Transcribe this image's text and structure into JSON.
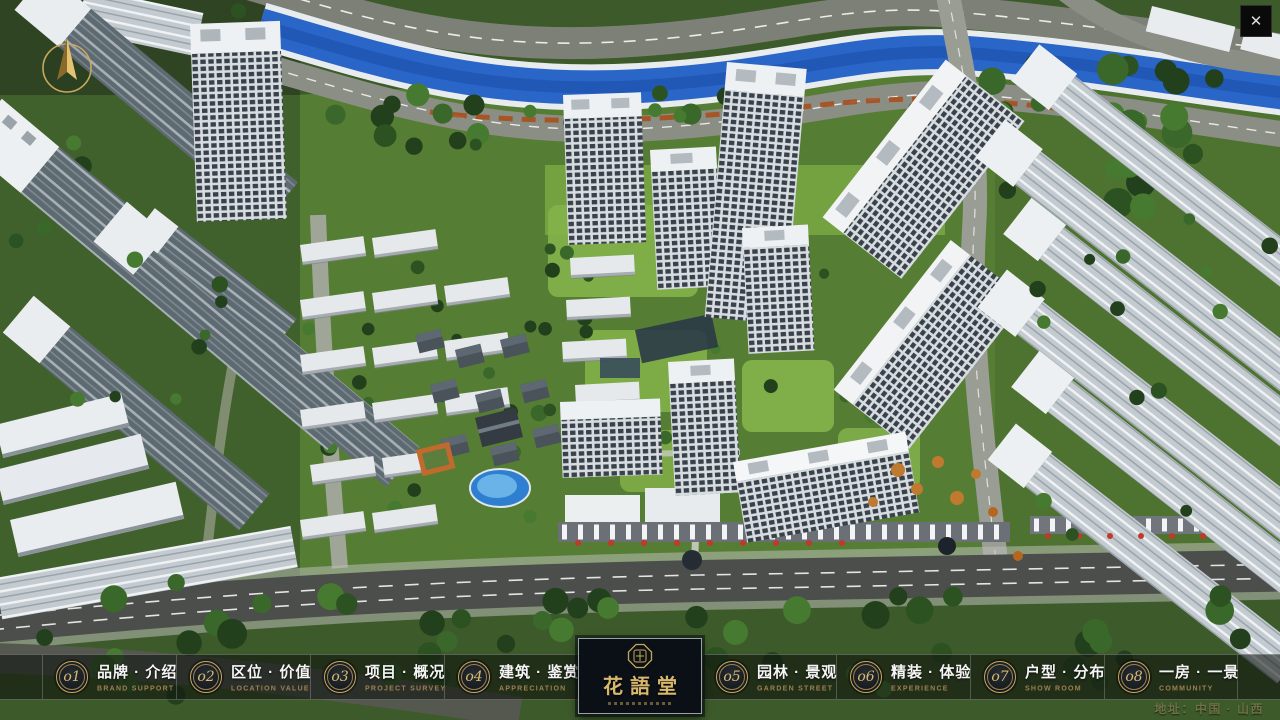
{
  "nav": {
    "items": [
      {
        "num": "o1",
        "zh": "品牌 · 介绍",
        "en": "BRAND SUPPORT"
      },
      {
        "num": "o2",
        "zh": "区位 · 价值",
        "en": "LOCATION VALUE"
      },
      {
        "num": "o3",
        "zh": "项目 · 概况",
        "en": "PROJECT SURVEY"
      },
      {
        "num": "o4",
        "zh": "建筑 · 鉴赏",
        "en": "APPRECIATION"
      },
      {
        "num": "o5",
        "zh": "园林 · 景观",
        "en": "GARDEN STREET"
      },
      {
        "num": "o6",
        "zh": "精装 · 体验",
        "en": "EXPERIENCE"
      },
      {
        "num": "o7",
        "zh": "户型 · 分布",
        "en": "SHOW ROOM"
      },
      {
        "num": "o8",
        "zh": "一房 · 一景",
        "en": "COMMUNITY"
      }
    ],
    "logo": {
      "title": "花語堂"
    }
  },
  "footer": {
    "address": "地址：中国 · 山西"
  },
  "icons": {
    "close": "✕"
  },
  "colors": {
    "gold": "#c9a85c",
    "gold_bright": "#d8b86d",
    "bar_bg": "#0e120d",
    "river_blue": "#2a66c8",
    "accent_red": "#c0392b"
  }
}
